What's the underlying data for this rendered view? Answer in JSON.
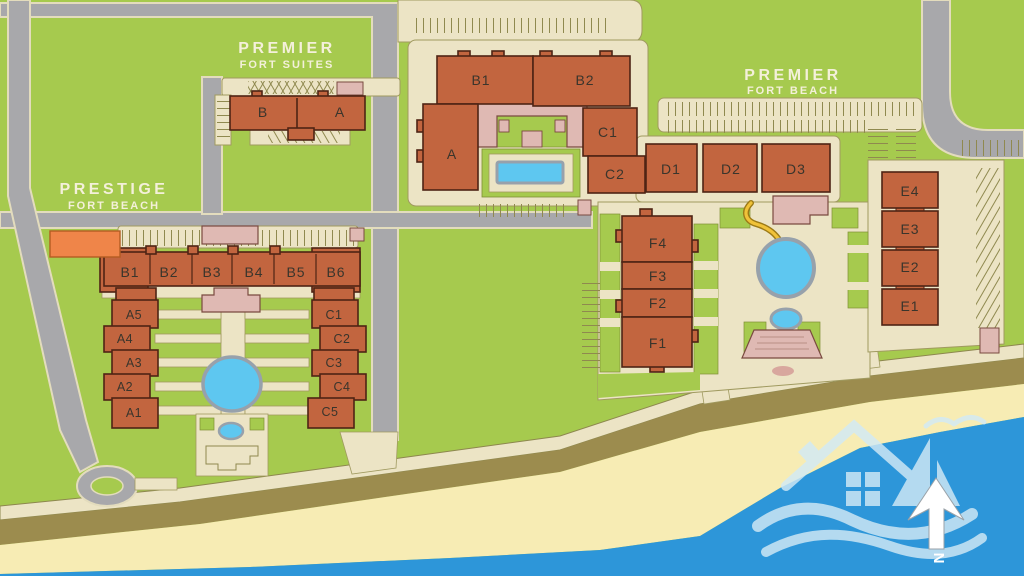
{
  "map": {
    "premier_fort_suites": {
      "name1": "PREMIER",
      "name2": "FORT SUITES",
      "bldg": {
        "b": "B",
        "a": "A"
      }
    },
    "premier_fort_beach": {
      "name1": "PREMIER",
      "name2": "FORT BEACH",
      "bldg": {
        "b1": "B1",
        "b2": "B2",
        "a": "A",
        "c1": "C1",
        "c2": "C2",
        "d1": "D1",
        "d2": "D2",
        "d3": "D3",
        "e4": "E4",
        "e3": "E3",
        "e2": "E2",
        "e1": "E1",
        "f4": "F4",
        "f3": "F3",
        "f2": "F2",
        "f1": "F1"
      }
    },
    "prestige_fort_beach": {
      "name1": "PRESTIGE",
      "name2": "FORT BEACH",
      "bldg": {
        "b1": "B1",
        "b2": "B2",
        "b3": "B3",
        "b4": "B4",
        "b5": "B5",
        "b6": "B6",
        "a5": "A5",
        "a4": "A4",
        "a3": "A3",
        "a2": "A2",
        "a1": "A1",
        "c1": "C1",
        "c2": "C2",
        "c3": "C3",
        "c4": "C4",
        "c5": "C5"
      }
    },
    "compass_n": "N",
    "colors": {
      "grass": "#a6ca4e",
      "road": "#a8a8ab",
      "path": "#ece4c5",
      "building": "#c2653f",
      "building_border": "#4e2414",
      "pink": "#dfb9b3",
      "orange": "#ef8549",
      "pool": "#5ec7f0",
      "sea": "#2d96d9",
      "sand": "#f7ecb4",
      "dune": "#9c8c4e",
      "slide": "#f0c239",
      "logo": "#d2eaf6"
    }
  }
}
